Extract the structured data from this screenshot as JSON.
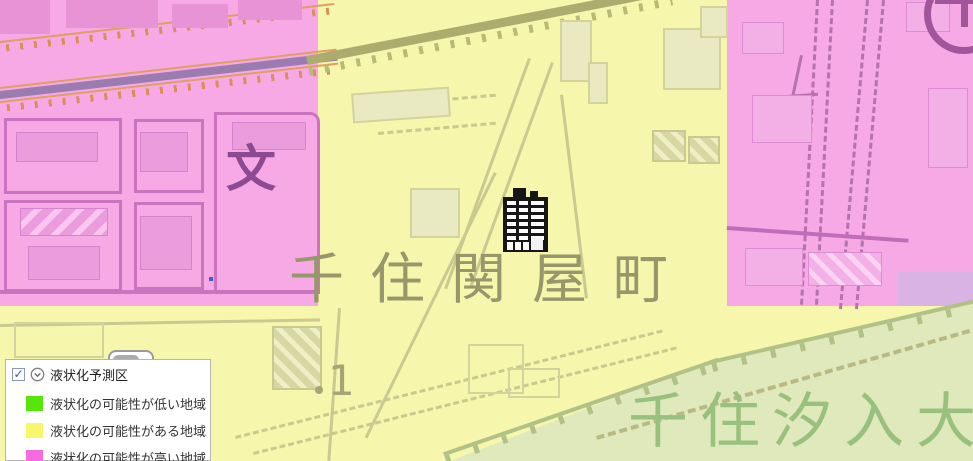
{
  "legend": {
    "title": "液状化予測区",
    "checkbox_mark": "✓",
    "items": [
      {
        "label": "液状化の可能性が低い地域",
        "color": "#57e60a"
      },
      {
        "label": "液状化の可能性がある地域",
        "color": "#f7f76b"
      },
      {
        "label": "液状化の可能性が高い地域",
        "color": "#f76be0"
      }
    ]
  },
  "map": {
    "district_label": "千住関屋町",
    "riverbank_label": "千住汐入大",
    "school_symbol": "文",
    "block_number": "1",
    "zone_colors": {
      "high_risk_pink": "#f7a9e6",
      "possible_yellow": "#f6f6ad",
      "riverbank_green": "#e0e9bc",
      "lavender_patch": "#d9b3e3"
    }
  }
}
